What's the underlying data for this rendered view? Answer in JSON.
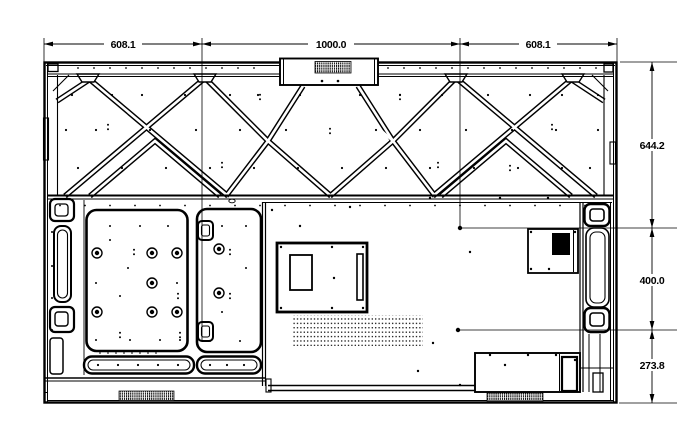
{
  "diagram": {
    "type": "rear-view-mechanical-drawing",
    "top_dims": {
      "left": "608.1",
      "center": "1000.0",
      "right": "608.1"
    },
    "right_dims": {
      "upper": "644.2",
      "middle": "400.0",
      "lower": "273.8"
    },
    "line_color": "#000000",
    "background_color": "#ffffff",
    "horizontal_dimensions_mm": [
      608.1,
      1000.0,
      608.1
    ],
    "vertical_dimensions_mm": [
      644.2,
      400.0,
      273.8
    ]
  }
}
